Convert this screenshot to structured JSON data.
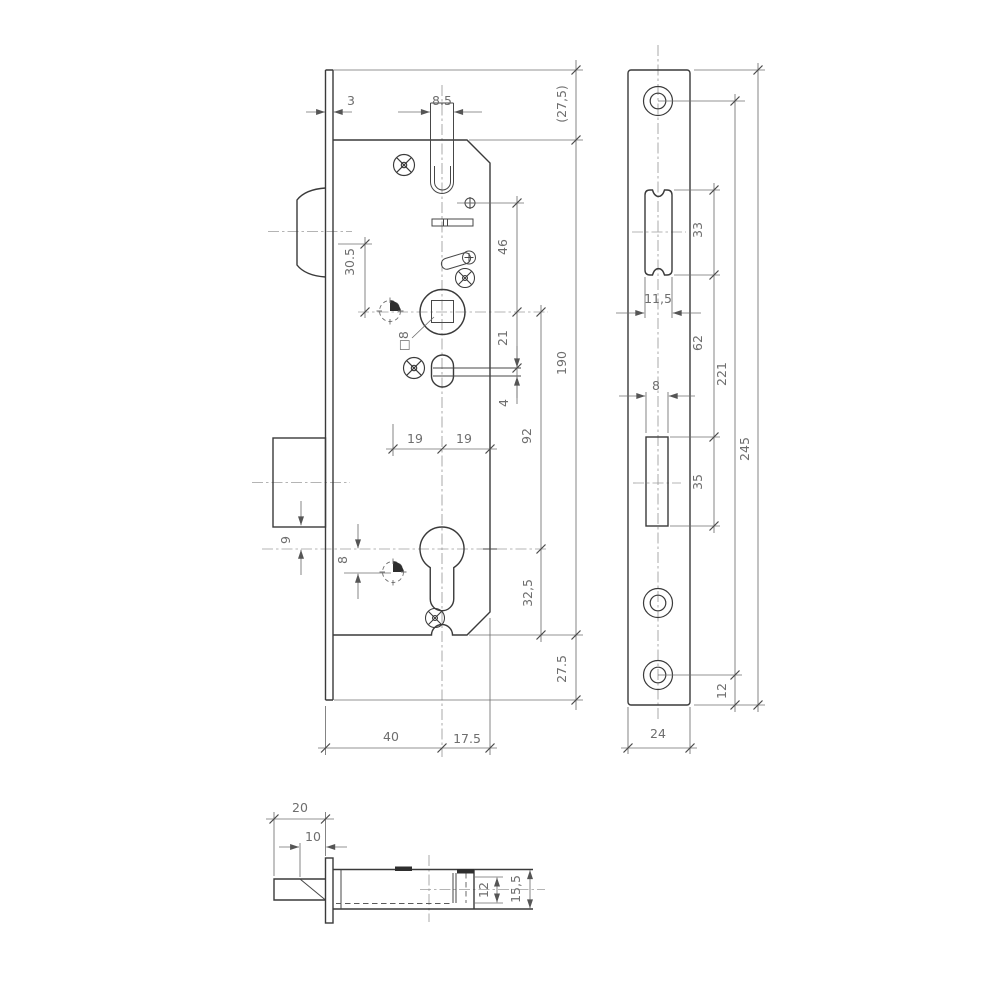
{
  "drawing": {
    "background": "#ffffff",
    "line_color": "#3a3a3a",
    "dim_color": "#6f6f6f",
    "front_view": {
      "dims": {
        "plate_offset": "3",
        "latch_width": "8.5",
        "top_overhang": "(27,5)",
        "latch_to_follower": "46",
        "latch_axis_to_follower": "30.5",
        "follower_square": "□8",
        "follower_to_slot": "21",
        "slot_gap": "4",
        "follower_to_cylinder": "92",
        "case_length": "190",
        "backset_half_left": "19",
        "backset_half_right": "19",
        "bolt_to_cylinder": "9",
        "cylinder_to_hub": "8",
        "cylinder_to_bottom": "32,5",
        "bottom_overhang": "27.5",
        "backset": "40",
        "case_depth_behind_axis": "17.5"
      }
    },
    "faceplate_view": {
      "dims": {
        "latch_cutout_length": "33",
        "latch_cutout_width": "11,5",
        "cutout_spacing": "62",
        "screw_spacing": "221",
        "plate_length": "245",
        "bolt_cutout_width": "8",
        "bolt_cutout_length": "35",
        "screw_to_edge": "12",
        "plate_width": "24"
      }
    },
    "latch_view": {
      "dims": {
        "head_length": "20",
        "bevel_length": "10",
        "bolt_thickness": "12",
        "tail_height": "15,5"
      }
    }
  }
}
